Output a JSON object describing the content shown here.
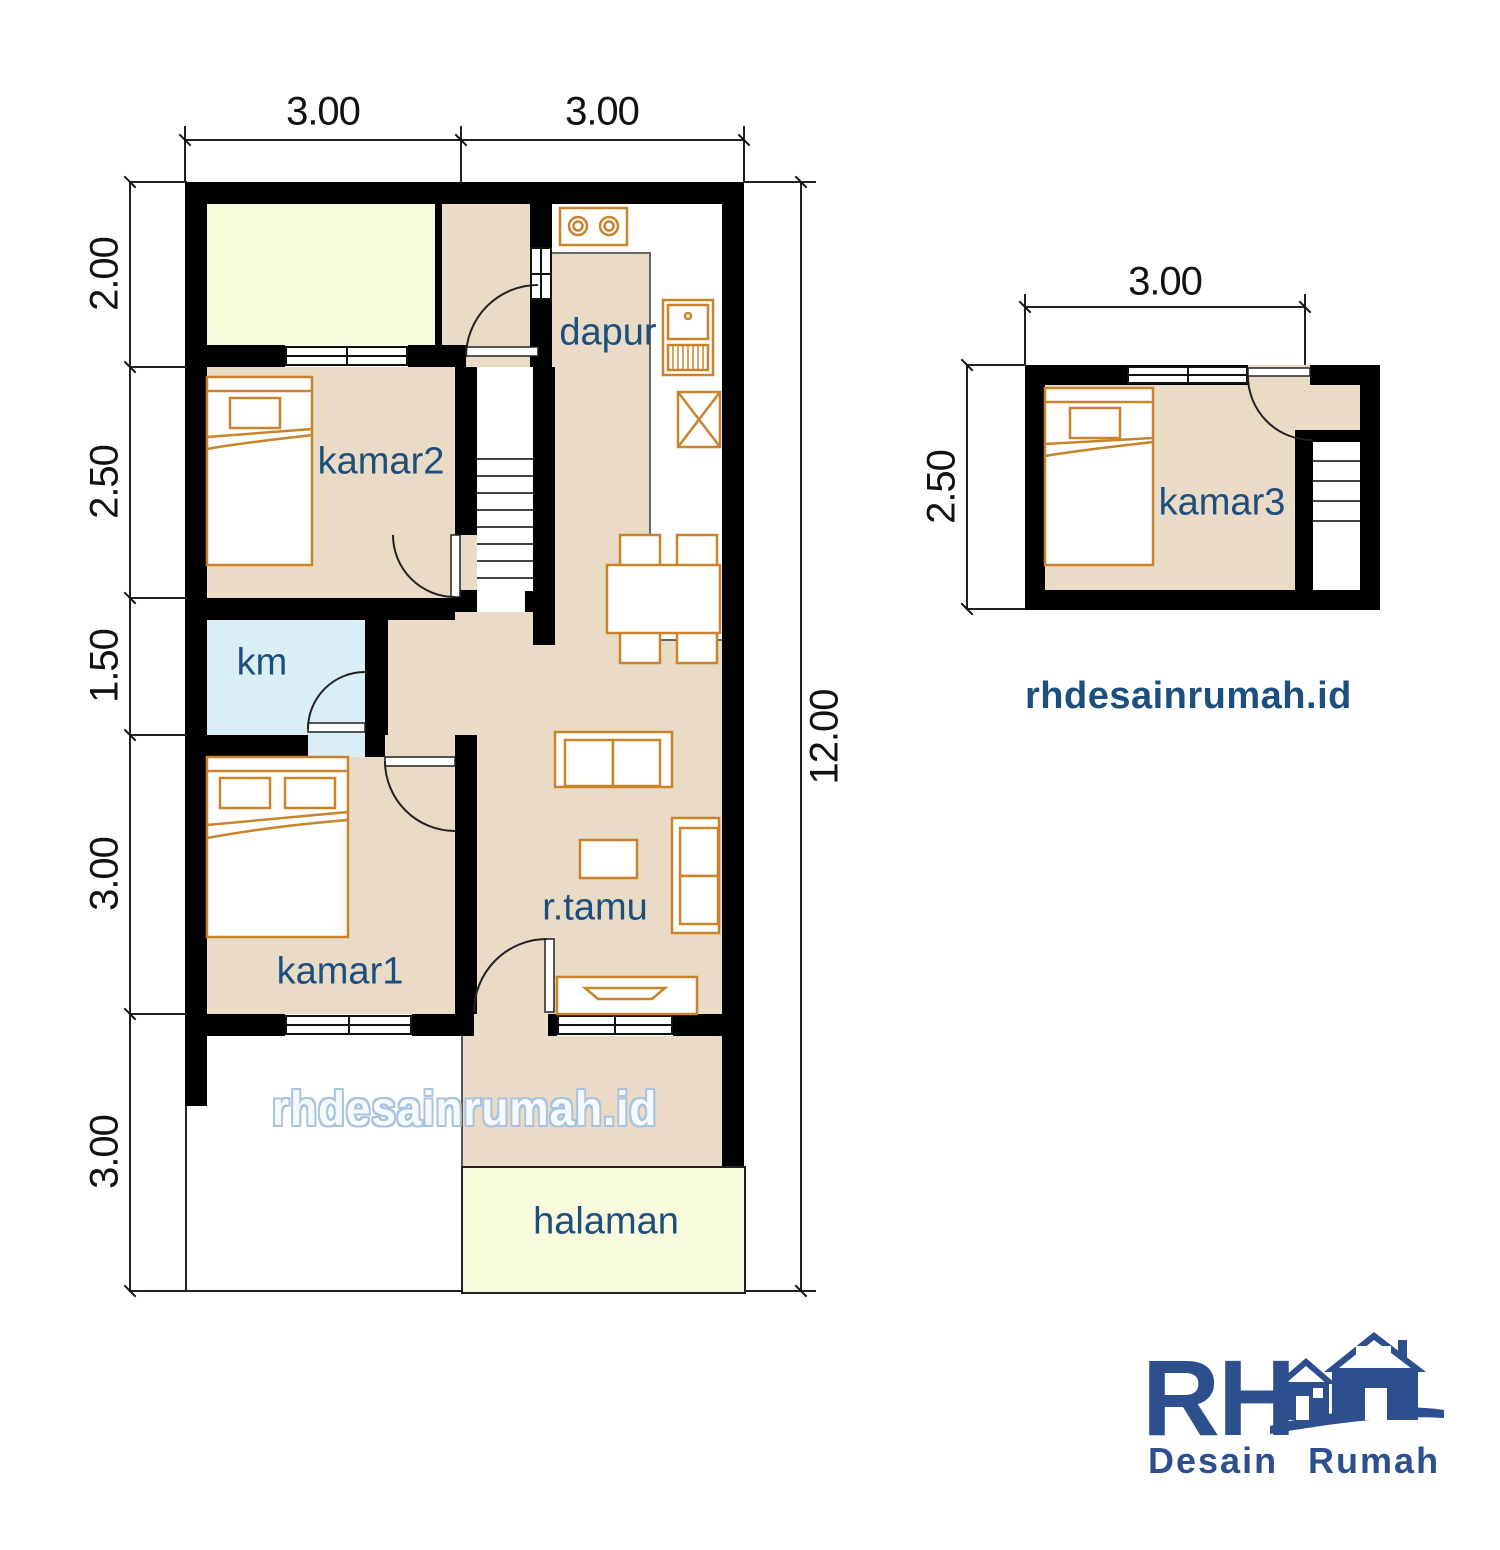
{
  "main_plan": {
    "dim_top": [
      "3.00",
      "3.00"
    ],
    "dim_left": [
      "2.00",
      "2.50",
      "1.50",
      "3.00",
      "3.00"
    ],
    "dim_right": "12.00",
    "rooms": {
      "dapur": "dapur",
      "kamar2": "kamar2",
      "km": "km",
      "kamar1": "kamar1",
      "rtamu": "r.tamu",
      "halaman": "halaman"
    },
    "watermark": "rhdesainrumah.id"
  },
  "upper_plan": {
    "dim_top": "3.00",
    "dim_left": "2.50",
    "room": "kamar3",
    "website": "rhdesainrumah.id"
  },
  "logo": {
    "initials": "RH",
    "name": "Desain Rumah"
  },
  "colors": {
    "wall": "#000000",
    "floor_tan": "#e9dbc5",
    "yard_yellow": "#f8fadd",
    "bathroom_blue": "#daeef7",
    "furniture_orange": "#c8832b",
    "label_blue": "#1c4e7e",
    "logo_blue": "#2e4f8e",
    "watermark_outline": "#a8c3de"
  }
}
